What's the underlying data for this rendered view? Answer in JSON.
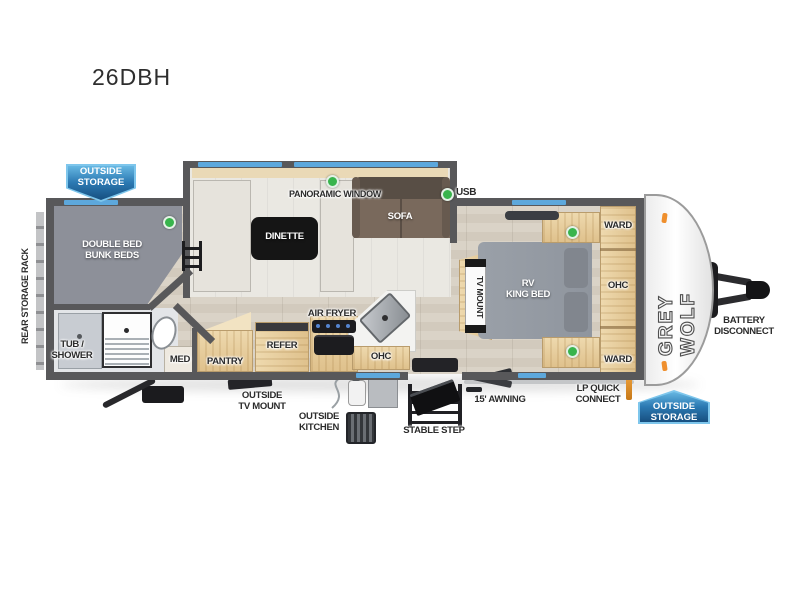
{
  "title": "26DBH",
  "badge": {
    "line1": "OUTSIDE",
    "line2": "STORAGE"
  },
  "exterior": {
    "rear_storage_rack": "REAR STORAGE RACK",
    "usb": "USB",
    "battery": {
      "line1": "BATTERY",
      "line2": "DISCONNECT"
    },
    "lp": {
      "line1": "LP QUICK",
      "line2": "CONNECT"
    },
    "awning": "15' AWNING",
    "stable_step": "STABLE STEP",
    "outside_kitchen": {
      "line1": "OUTSIDE",
      "line2": "KITCHEN"
    },
    "outside_tv": {
      "line1": "OUTSIDE",
      "line2": "TV MOUNT"
    },
    "brand": "GREY WOLF"
  },
  "interior": {
    "bunks": {
      "line1": "DOUBLE BED",
      "line2": "BUNK BEDS"
    },
    "tub_shower": {
      "line1": "TUB /",
      "line2": "SHOWER"
    },
    "med": "MED",
    "pantry": "PANTRY",
    "refer": "REFER",
    "air_fryer": "AIR FRYER",
    "kitchen_ohc": "OHC",
    "dinette": "DINETTE",
    "panoramic_window": "PANORAMIC WINDOW",
    "sofa": "SOFA",
    "tv_mount": "TV MOUNT",
    "king_bed": {
      "line1": "RV",
      "line2": "KING BED"
    },
    "ward_top": "WARD",
    "bedroom_ohc": "OHC",
    "ward_bottom": "WARD"
  },
  "colors": {
    "badge_blue_dark": "#174f80",
    "badge_blue_light": "#66b7e2",
    "window_blue": "#5da8dc",
    "indicator_green": "#38b44c",
    "wall_gray": "#58585a",
    "cabinet_wood": "#e5c998",
    "bed_gray": "#989ea6",
    "sofa_brown": "#79695c",
    "marker_orange": "#ef8f2d"
  }
}
